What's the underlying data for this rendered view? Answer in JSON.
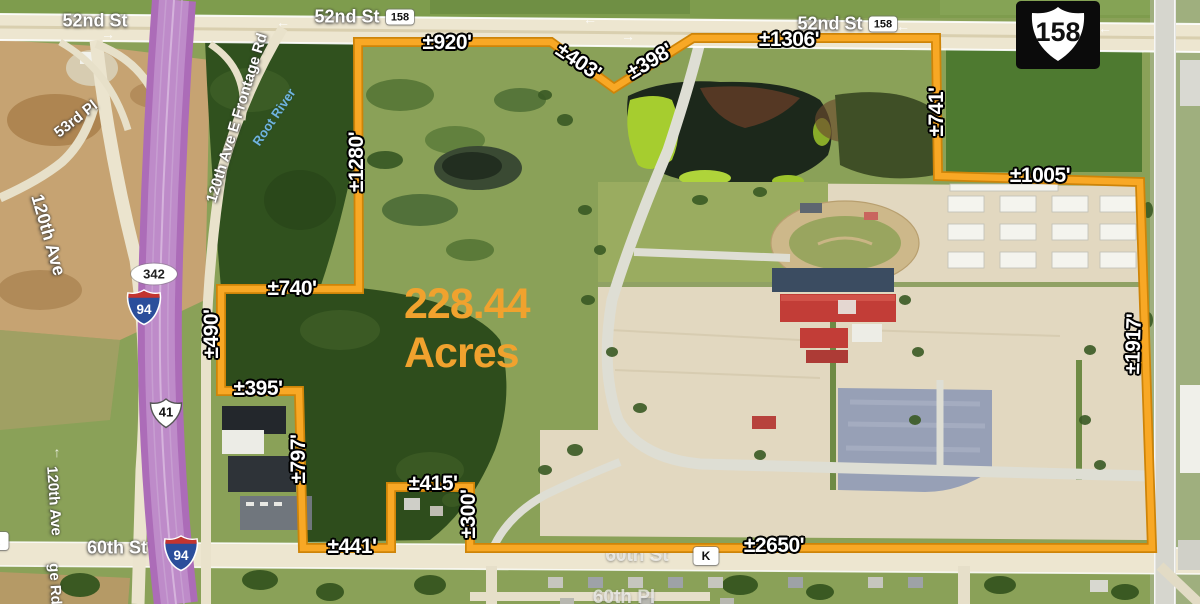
{
  "map": {
    "acreage": {
      "value": "228.44",
      "unit": "Acres",
      "color": "#F0A22E",
      "x": 404,
      "y": 280
    },
    "boundary": {
      "color": "#F8A825",
      "edge_color": "#CE8408",
      "points": [
        [
          358,
          42
        ],
        [
          551,
          42
        ],
        [
          614,
          88
        ],
        [
          693,
          38
        ],
        [
          936,
          38
        ],
        [
          938,
          176
        ],
        [
          1140,
          182
        ],
        [
          1152,
          548
        ],
        [
          470,
          548
        ],
        [
          470,
          487
        ],
        [
          391,
          487
        ],
        [
          391,
          548
        ],
        [
          303,
          548
        ],
        [
          299,
          391
        ],
        [
          221,
          391
        ],
        [
          221,
          289
        ],
        [
          359,
          289
        ]
      ]
    },
    "dimension_labels": [
      {
        "text": "±920'",
        "x": 447,
        "y": 43,
        "rot": 0
      },
      {
        "text": "±403'",
        "x": 578,
        "y": 62,
        "rot": 34
      },
      {
        "text": "±398'",
        "x": 650,
        "y": 62,
        "rot": -31
      },
      {
        "text": "±1306'",
        "x": 789,
        "y": 40,
        "rot": 0
      },
      {
        "text": "±741'",
        "x": 937,
        "y": 112,
        "rot": -90
      },
      {
        "text": "±1005'",
        "x": 1040,
        "y": 176,
        "rot": 0
      },
      {
        "text": "±1917'",
        "x": 1134,
        "y": 344,
        "rot": -88
      },
      {
        "text": "±2650'",
        "x": 774,
        "y": 546,
        "rot": 0
      },
      {
        "text": "±300'",
        "x": 469,
        "y": 514,
        "rot": -90
      },
      {
        "text": "±415'",
        "x": 433,
        "y": 484,
        "rot": 0
      },
      {
        "text": "±441'",
        "x": 352,
        "y": 547,
        "rot": 0
      },
      {
        "text": "±797'",
        "x": 299,
        "y": 459,
        "rot": -90
      },
      {
        "text": "±395'",
        "x": 258,
        "y": 389,
        "rot": 0
      },
      {
        "text": "±490'",
        "x": 212,
        "y": 334,
        "rot": -90
      },
      {
        "text": "±740'",
        "x": 292,
        "y": 289,
        "rot": 0
      },
      {
        "text": "±1280'",
        "x": 357,
        "y": 162,
        "rot": -90
      }
    ],
    "road_labels": [
      {
        "text": "52nd St",
        "x": 95,
        "y": 21,
        "rot": 0,
        "cls": "road-lg"
      },
      {
        "text": "52nd St",
        "x": 347,
        "y": 17,
        "rot": 0,
        "cls": "road-lg"
      },
      {
        "text": "52nd St",
        "x": 830,
        "y": 24,
        "rot": 0,
        "cls": "road-lg"
      },
      {
        "text": "53rd Pl",
        "x": 76,
        "y": 119,
        "rot": -38,
        "cls": "road-md"
      },
      {
        "text": "120th Ave E Frontage Rd",
        "x": 237,
        "y": 118,
        "rot": -73,
        "cls": "road-md"
      },
      {
        "text": "Root River",
        "x": 274,
        "y": 117,
        "rot": -56,
        "cls": "water"
      },
      {
        "text": "120th Ave",
        "x": 48,
        "y": 235,
        "rot": 74,
        "cls": "road-lg"
      },
      {
        "text": "120th Ave",
        "x": 54,
        "y": 501,
        "rot": 86,
        "cls": "road-md"
      },
      {
        "text": "ge Rd",
        "x": 55,
        "y": 584,
        "rot": 87,
        "cls": "road-md"
      },
      {
        "text": "60th St",
        "x": 117,
        "y": 548,
        "rot": 0,
        "cls": "road-lg"
      },
      {
        "text": "60th St",
        "x": 637,
        "y": 556,
        "rot": 0,
        "cls": "road-faint",
        "layer": "under"
      },
      {
        "text": "60th Pl",
        "x": 624,
        "y": 598,
        "rot": 0,
        "cls": "road-faint",
        "layer": "under"
      }
    ],
    "shields": [
      {
        "type": "us-large",
        "text": "158",
        "x": 1058,
        "y": 35,
        "w": 84,
        "h": 68
      },
      {
        "type": "badge",
        "text": "158",
        "x": 400,
        "y": 17,
        "w": 28,
        "h": 15
      },
      {
        "type": "badge",
        "text": "158",
        "x": 883,
        "y": 24,
        "w": 28,
        "h": 15
      },
      {
        "type": "oval",
        "text": "342",
        "x": 154,
        "y": 274,
        "w": 46,
        "h": 21
      },
      {
        "type": "interstate",
        "text": "94",
        "x": 144,
        "y": 307,
        "w": 36,
        "h": 38
      },
      {
        "type": "interstate",
        "text": "94",
        "x": 181,
        "y": 553,
        "w": 36,
        "h": 38
      },
      {
        "type": "us",
        "text": "41",
        "x": 166,
        "y": 413,
        "w": 38,
        "h": 34
      },
      {
        "type": "badge",
        "text": "K",
        "x": 706,
        "y": 556,
        "w": 25,
        "h": 18
      },
      {
        "type": "badge",
        "text": "K",
        "x": -4,
        "y": 541,
        "w": 25,
        "h": 18
      }
    ],
    "arrows": [
      {
        "glyph": "←",
        "x": 283,
        "y": 22
      },
      {
        "glyph": "←",
        "x": 590,
        "y": 19
      },
      {
        "glyph": "←",
        "x": 903,
        "y": 26
      },
      {
        "glyph": "←",
        "x": 1105,
        "y": 28
      },
      {
        "glyph": "→",
        "x": 108,
        "y": 34
      },
      {
        "glyph": "→",
        "x": 628,
        "y": 36
      },
      {
        "glyph": "↑",
        "x": 57,
        "y": 452
      }
    ]
  }
}
